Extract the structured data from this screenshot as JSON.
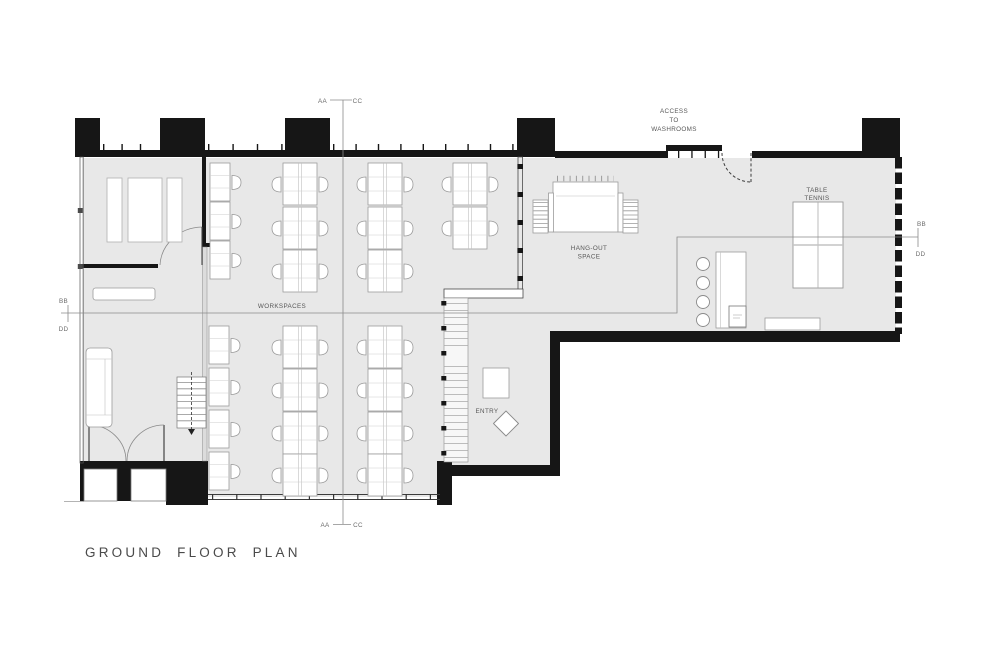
{
  "drawing_title": "GROUND FLOOR PLAN",
  "labels": {
    "workspaces": "WORKSPACES",
    "hangout_line1": "HANG-OUT",
    "hangout_line2": "SPACE",
    "entry": "ENTRY",
    "table_tennis_line1": "TABLE",
    "table_tennis_line2": "TENNIS",
    "washrooms_line1": "ACCESS",
    "washrooms_line2": "TO",
    "washrooms_line3": "WASHROOMS"
  },
  "section_markers": {
    "top": {
      "left": "AA",
      "right": "CC"
    },
    "bottom": {
      "left": "AA",
      "right": "CC"
    },
    "left": {
      "top": "BB",
      "bottom": "DD"
    },
    "right": {
      "top": "BB",
      "bottom": "DD"
    }
  },
  "colors": {
    "background": "#ffffff",
    "floor": "#e8e8e8",
    "wall": "#161616",
    "section_line": "#8a8a8a",
    "furniture_stroke": "#9b9b9b",
    "label_text": "#575757",
    "title_text": "#4a4a4a"
  }
}
